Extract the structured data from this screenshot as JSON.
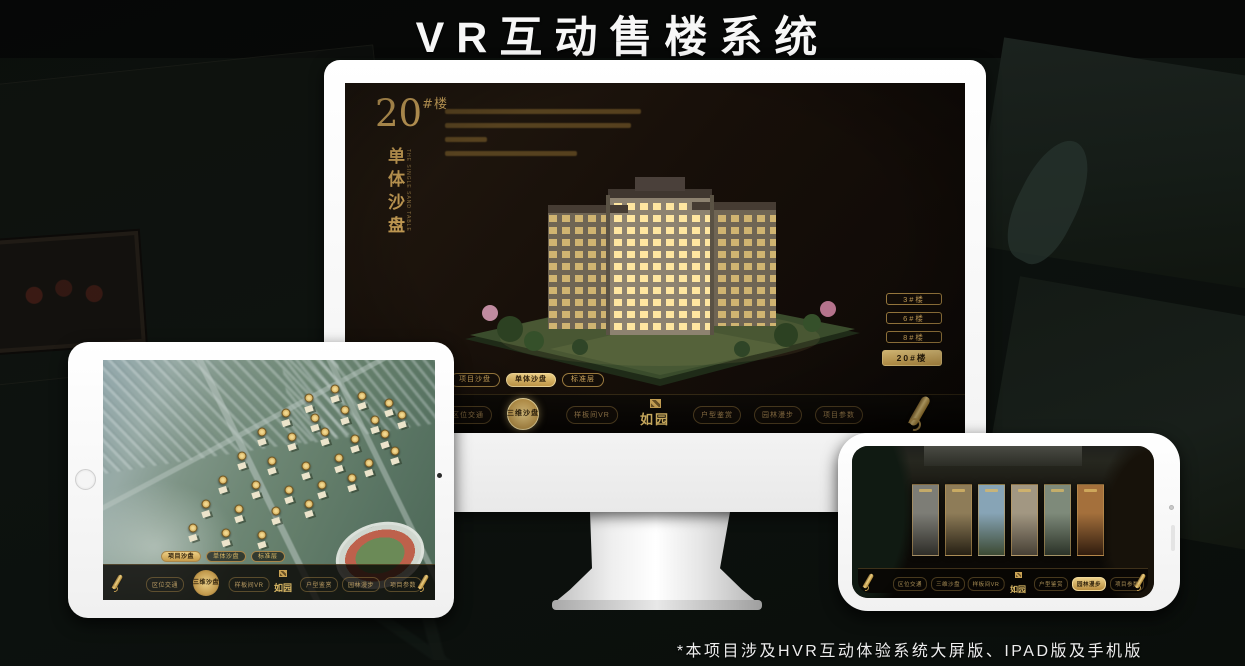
{
  "title": "VR互动售楼系统",
  "footnote": "*本项目涉及HVR互动体验系统大屏版、IPAD版及手机版",
  "colors": {
    "gold": "#cda55c",
    "gold_bright": "#e7c87d",
    "screen_bg": "#17110a",
    "white": "#f7f7f7"
  },
  "brand": {
    "logo_text": "如园",
    "logo_seal_icon": "seal-icon"
  },
  "nav_items": [
    {
      "label": "区位交通"
    },
    {
      "label": "三维沙盘"
    },
    {
      "label": "样板间VR"
    },
    {
      "label": "户型鉴赏"
    },
    {
      "label": "园林漫步"
    },
    {
      "label": "项目参数"
    }
  ],
  "mode_tabs": [
    {
      "label": "项目沙盘"
    },
    {
      "label": "单体沙盘"
    },
    {
      "label": "标准层"
    }
  ],
  "monitor": {
    "block_number": "20",
    "block_unit": "#楼",
    "block_subtitle": "单体沙盘",
    "block_subtitle_en": "THE SINGLE SAND TABLE",
    "active_mode": "单体沙盘",
    "active_nav": "三维沙盘",
    "floor_buttons": [
      {
        "label": "3#楼",
        "active": false
      },
      {
        "label": "6#楼",
        "active": false
      },
      {
        "label": "8#楼",
        "active": false
      },
      {
        "label": "20#楼",
        "active": true
      }
    ],
    "scroll_icon": "scroll-icon"
  },
  "tablet": {
    "active_mode": "项目沙盘",
    "active_nav": "三维沙盘",
    "badges": [
      [
        62,
        16
      ],
      [
        70,
        12
      ],
      [
        78,
        15
      ],
      [
        86,
        18
      ],
      [
        55,
        22
      ],
      [
        64,
        24
      ],
      [
        73,
        21
      ],
      [
        82,
        25
      ],
      [
        90,
        23
      ],
      [
        48,
        30
      ],
      [
        57,
        32
      ],
      [
        67,
        30
      ],
      [
        76,
        33
      ],
      [
        85,
        31
      ],
      [
        42,
        40
      ],
      [
        51,
        42
      ],
      [
        61,
        44
      ],
      [
        71,
        41
      ],
      [
        80,
        43
      ],
      [
        88,
        38
      ],
      [
        36,
        50
      ],
      [
        46,
        52
      ],
      [
        56,
        54
      ],
      [
        66,
        52
      ],
      [
        75,
        49
      ],
      [
        31,
        60
      ],
      [
        41,
        62
      ],
      [
        52,
        63
      ],
      [
        62,
        60
      ],
      [
        27,
        70
      ],
      [
        37,
        72
      ],
      [
        48,
        73
      ]
    ]
  },
  "phone": {
    "active_nav": "园林漫步",
    "panels": [
      {
        "top": "#7d7d76",
        "bottom": "#2e2d28"
      },
      {
        "top": "#8e7c58",
        "bottom": "#262014"
      },
      {
        "top": "#87a4b6",
        "bottom": "#3c4a33"
      },
      {
        "top": "#a29782",
        "bottom": "#474035"
      },
      {
        "top": "#7e8a7a",
        "bottom": "#2b3328"
      },
      {
        "top": "#a4703c",
        "bottom": "#301c0e"
      }
    ]
  }
}
